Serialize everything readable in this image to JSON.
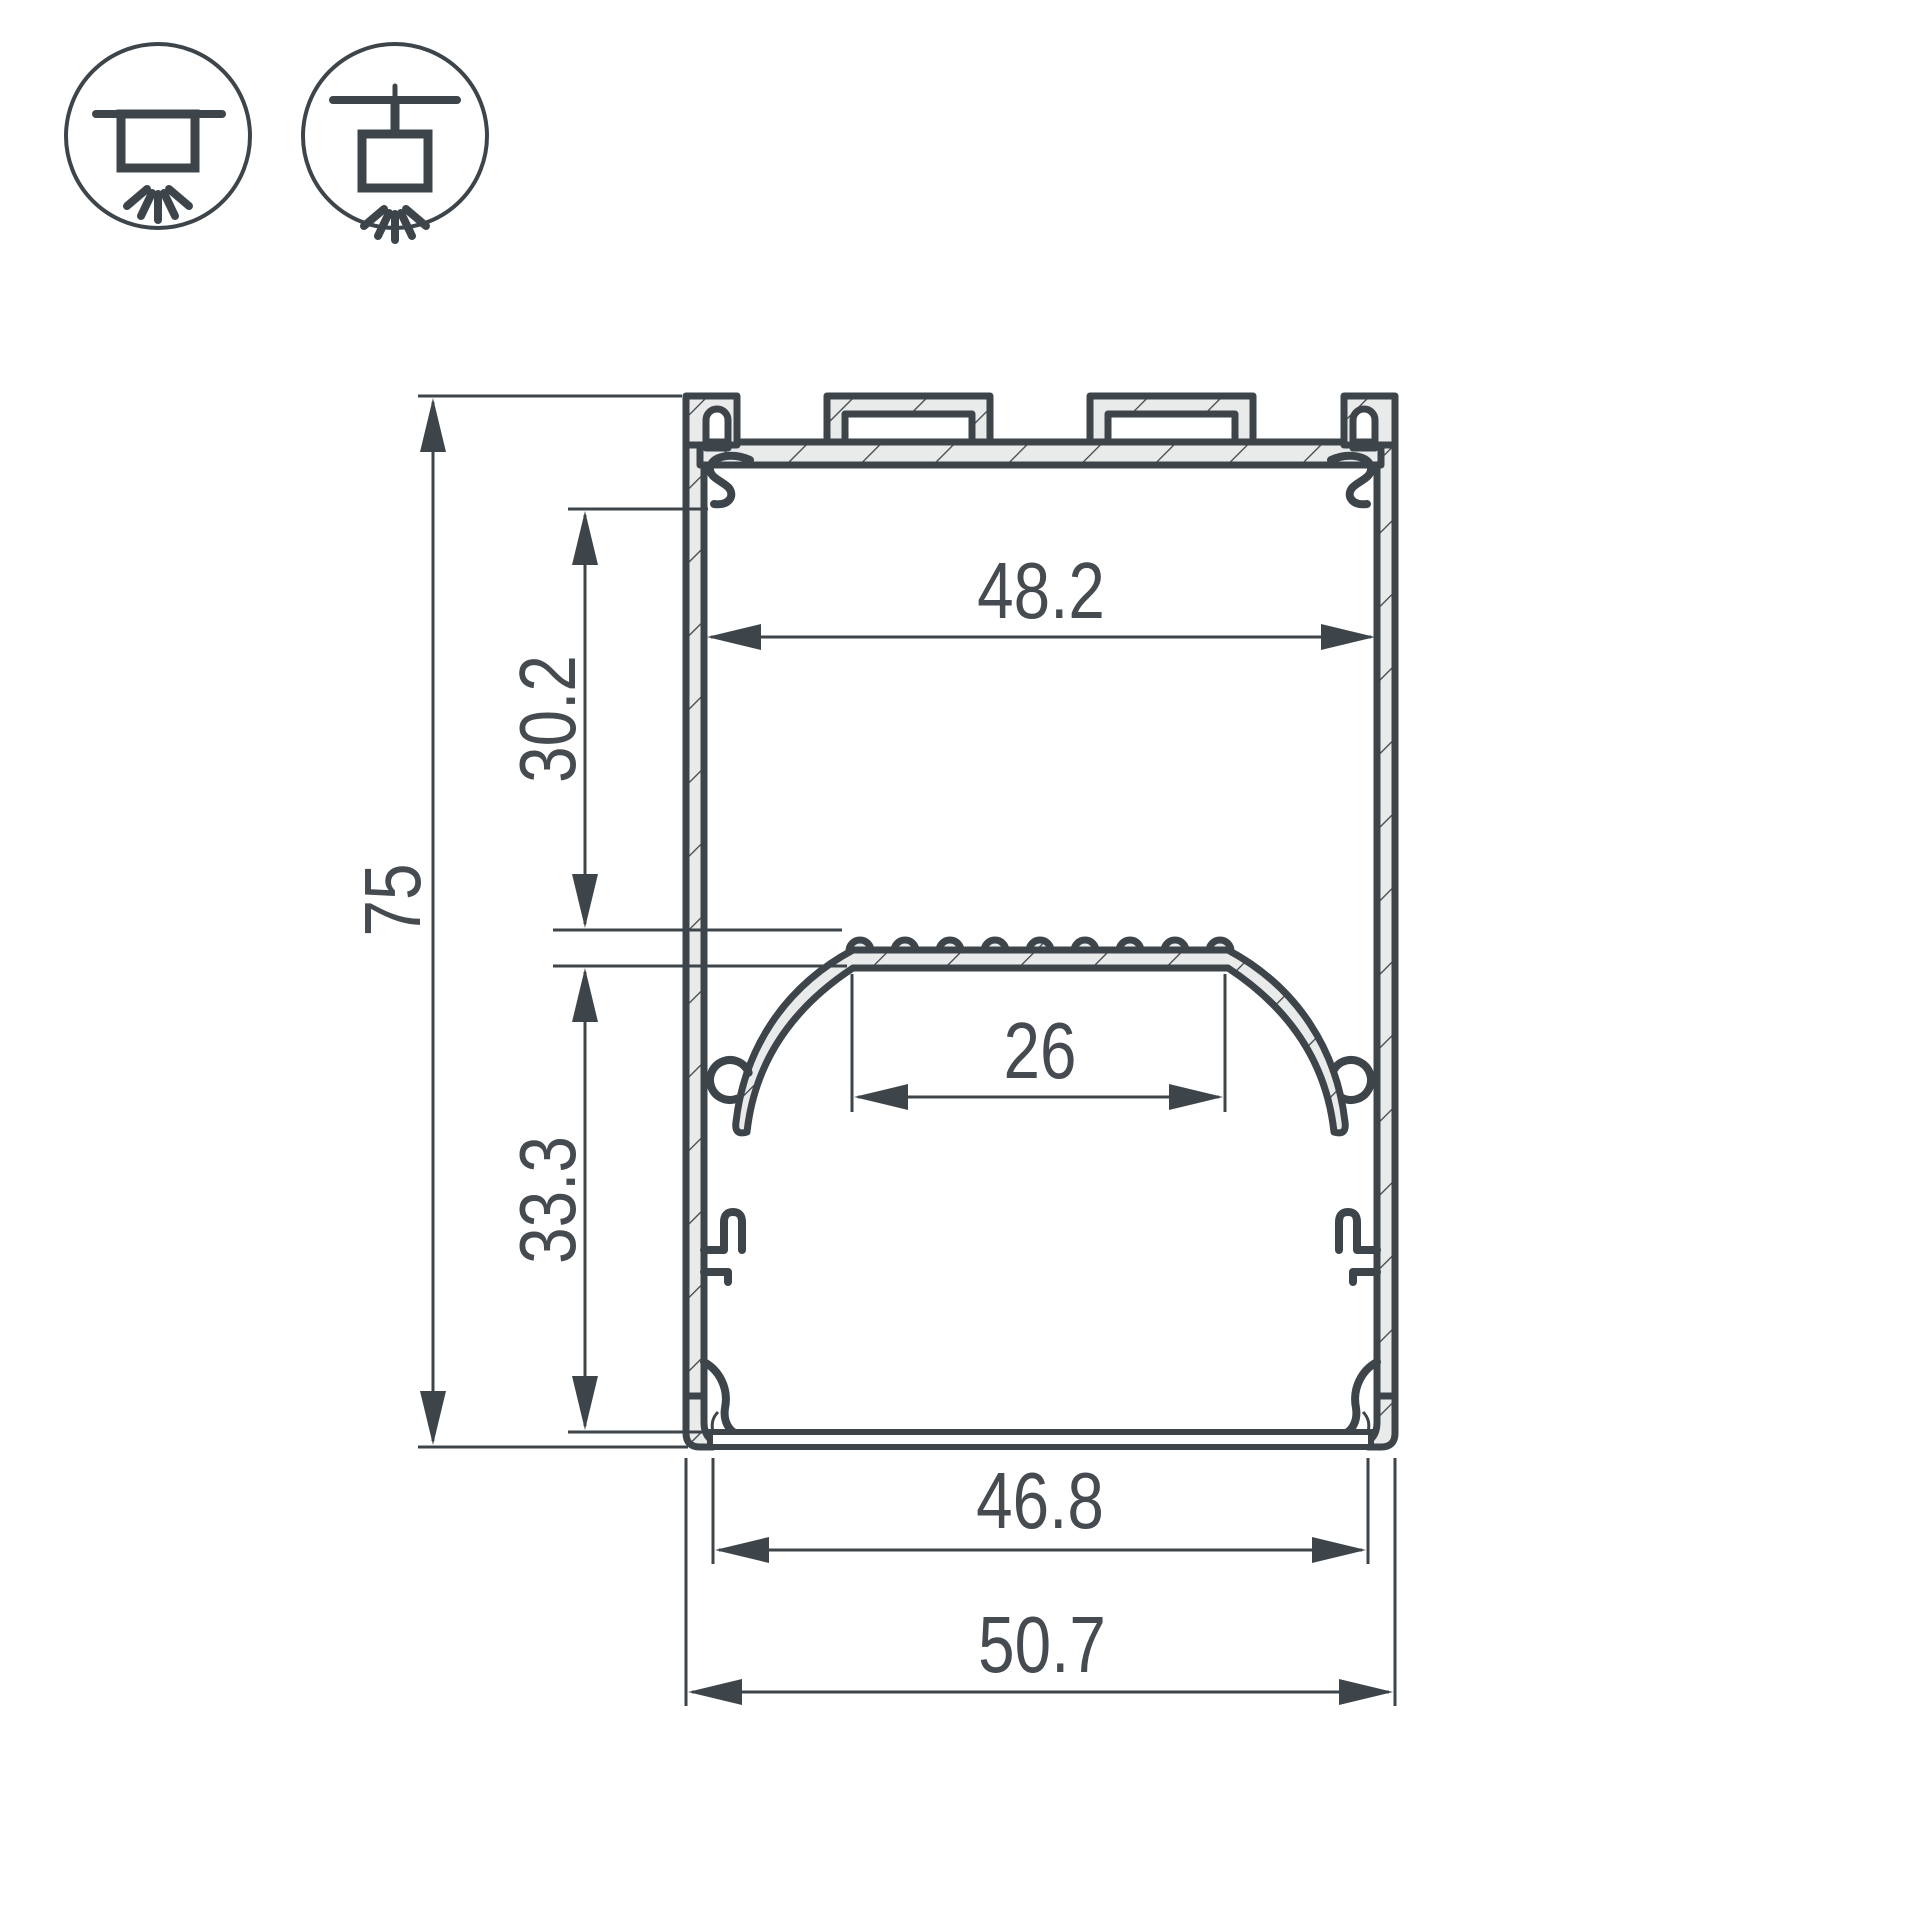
{
  "page": {
    "background": "#ffffff"
  },
  "drawing": {
    "subject": "Aluminium LED profile cross-section technical drawing",
    "colors": {
      "outline": "#3e454a",
      "material_fill": "#e9eaea",
      "dimension_text": "#454b50",
      "background": "#ffffff"
    },
    "mount_icons": [
      {
        "name": "surface-mount-icon"
      },
      {
        "name": "pendant-mount-icon"
      }
    ],
    "dimensions": {
      "overall_height": "75",
      "upper_cavity_depth": "30.2",
      "lower_cavity_depth": "33.3",
      "inner_width": "48.2",
      "diffuser_flat_width": "26",
      "bottom_opening_width": "46.8",
      "overall_width": "50.7"
    }
  }
}
